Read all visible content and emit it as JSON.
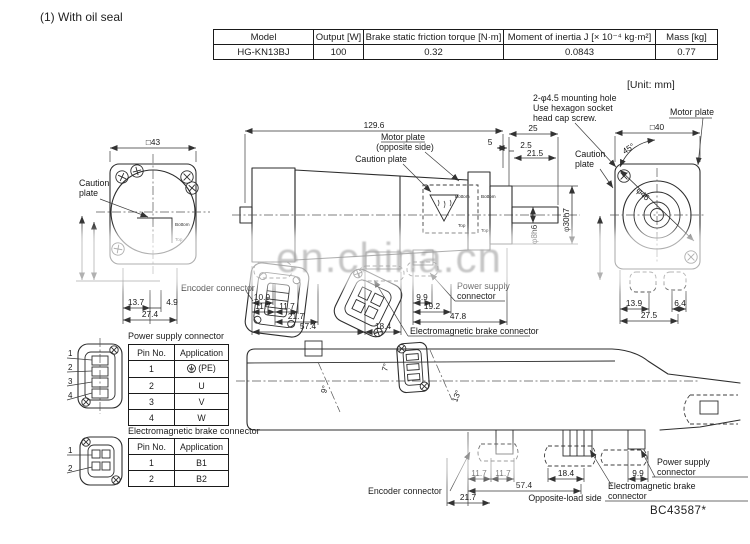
{
  "title": "(1) With oil seal",
  "unit_note": "[Unit: mm]",
  "doc_number": "BC43587*",
  "watermark": "en.china.cn",
  "spec_table": {
    "headers": [
      "Model",
      "Output [W]",
      "Brake static friction torque [N·m]",
      "Moment of inertia J [× 10⁻⁴ kg·m²]",
      "Mass [kg]"
    ],
    "row": [
      "HG-KN13BJ",
      "100",
      "0.32",
      "0.0843",
      "0.77"
    ]
  },
  "labels": {
    "caution_plate_1": "Caution",
    "caution_plate_2": "plate",
    "caution_plate": "Caution plate",
    "motor_plate": "Motor plate",
    "opposite_side": "(opposite side)",
    "encoder_connector": "Encoder connector",
    "power_supply_1": "Power supply",
    "power_supply_2": "connector",
    "electromagnetic_brake_connector": "Electromagnetic brake connector",
    "electromagnetic_brake_1": "Electromagnetic brake",
    "electromagnetic_brake_2": "connector",
    "mounting_note_1": "2-φ4.5 mounting hole",
    "mounting_note_2": "Use hexagon socket",
    "mounting_note_3": "head cap screw.",
    "opposite_load_side": "Opposite-load side",
    "bottom": "Bottom",
    "top": "Top"
  },
  "dimensions": {
    "front": {
      "width": "□43",
      "a": "13.7",
      "b": "4.9",
      "c": "27.4"
    },
    "side": {
      "overall": "129.6",
      "rear_total": "25",
      "rear_gap": "5",
      "rear_step": "2.5",
      "rear_shaft_len": "21.5",
      "shaft_dia": "φ8h6",
      "spigot_dia": "φ30h7",
      "enc_offset": "10.9",
      "enc_a": "11.7",
      "enc_b": "11.7",
      "enc_c": "21.7",
      "enc_total": "57.4",
      "brake_w": "18.4",
      "pwr_a": "9.9",
      "pwr_b": "19.2",
      "pwr_c": "47.8"
    },
    "rear": {
      "width": "□40",
      "pilot_dia": "φ46",
      "mount_angle": "45°",
      "a": "13.9",
      "b": "6.4",
      "c": "27.5"
    },
    "bottom": {
      "a": "11.7",
      "b": "11.7",
      "c": "18.4",
      "d": "9.9",
      "total": "57.4",
      "enc": "21.7",
      "angle_enc": "9°",
      "angle_pwr": "7°",
      "angle_brk": "13°"
    }
  },
  "connector_tables": {
    "power": {
      "title": "Power supply connector",
      "headers": [
        "Pin No.",
        "Application"
      ],
      "rows": [
        [
          "1",
          "(PE)"
        ],
        [
          "2",
          "U"
        ],
        [
          "3",
          "V"
        ],
        [
          "4",
          "W"
        ]
      ],
      "pins": [
        "1",
        "2",
        "3",
        "4"
      ]
    },
    "brake": {
      "title": "Electromagnetic brake connector",
      "headers": [
        "Pin No.",
        "Application"
      ],
      "rows": [
        [
          "1",
          "B1"
        ],
        [
          "2",
          "B2"
        ]
      ],
      "pins": [
        "1",
        "2"
      ]
    }
  },
  "icons": {
    "earth_ground": "⏚"
  }
}
